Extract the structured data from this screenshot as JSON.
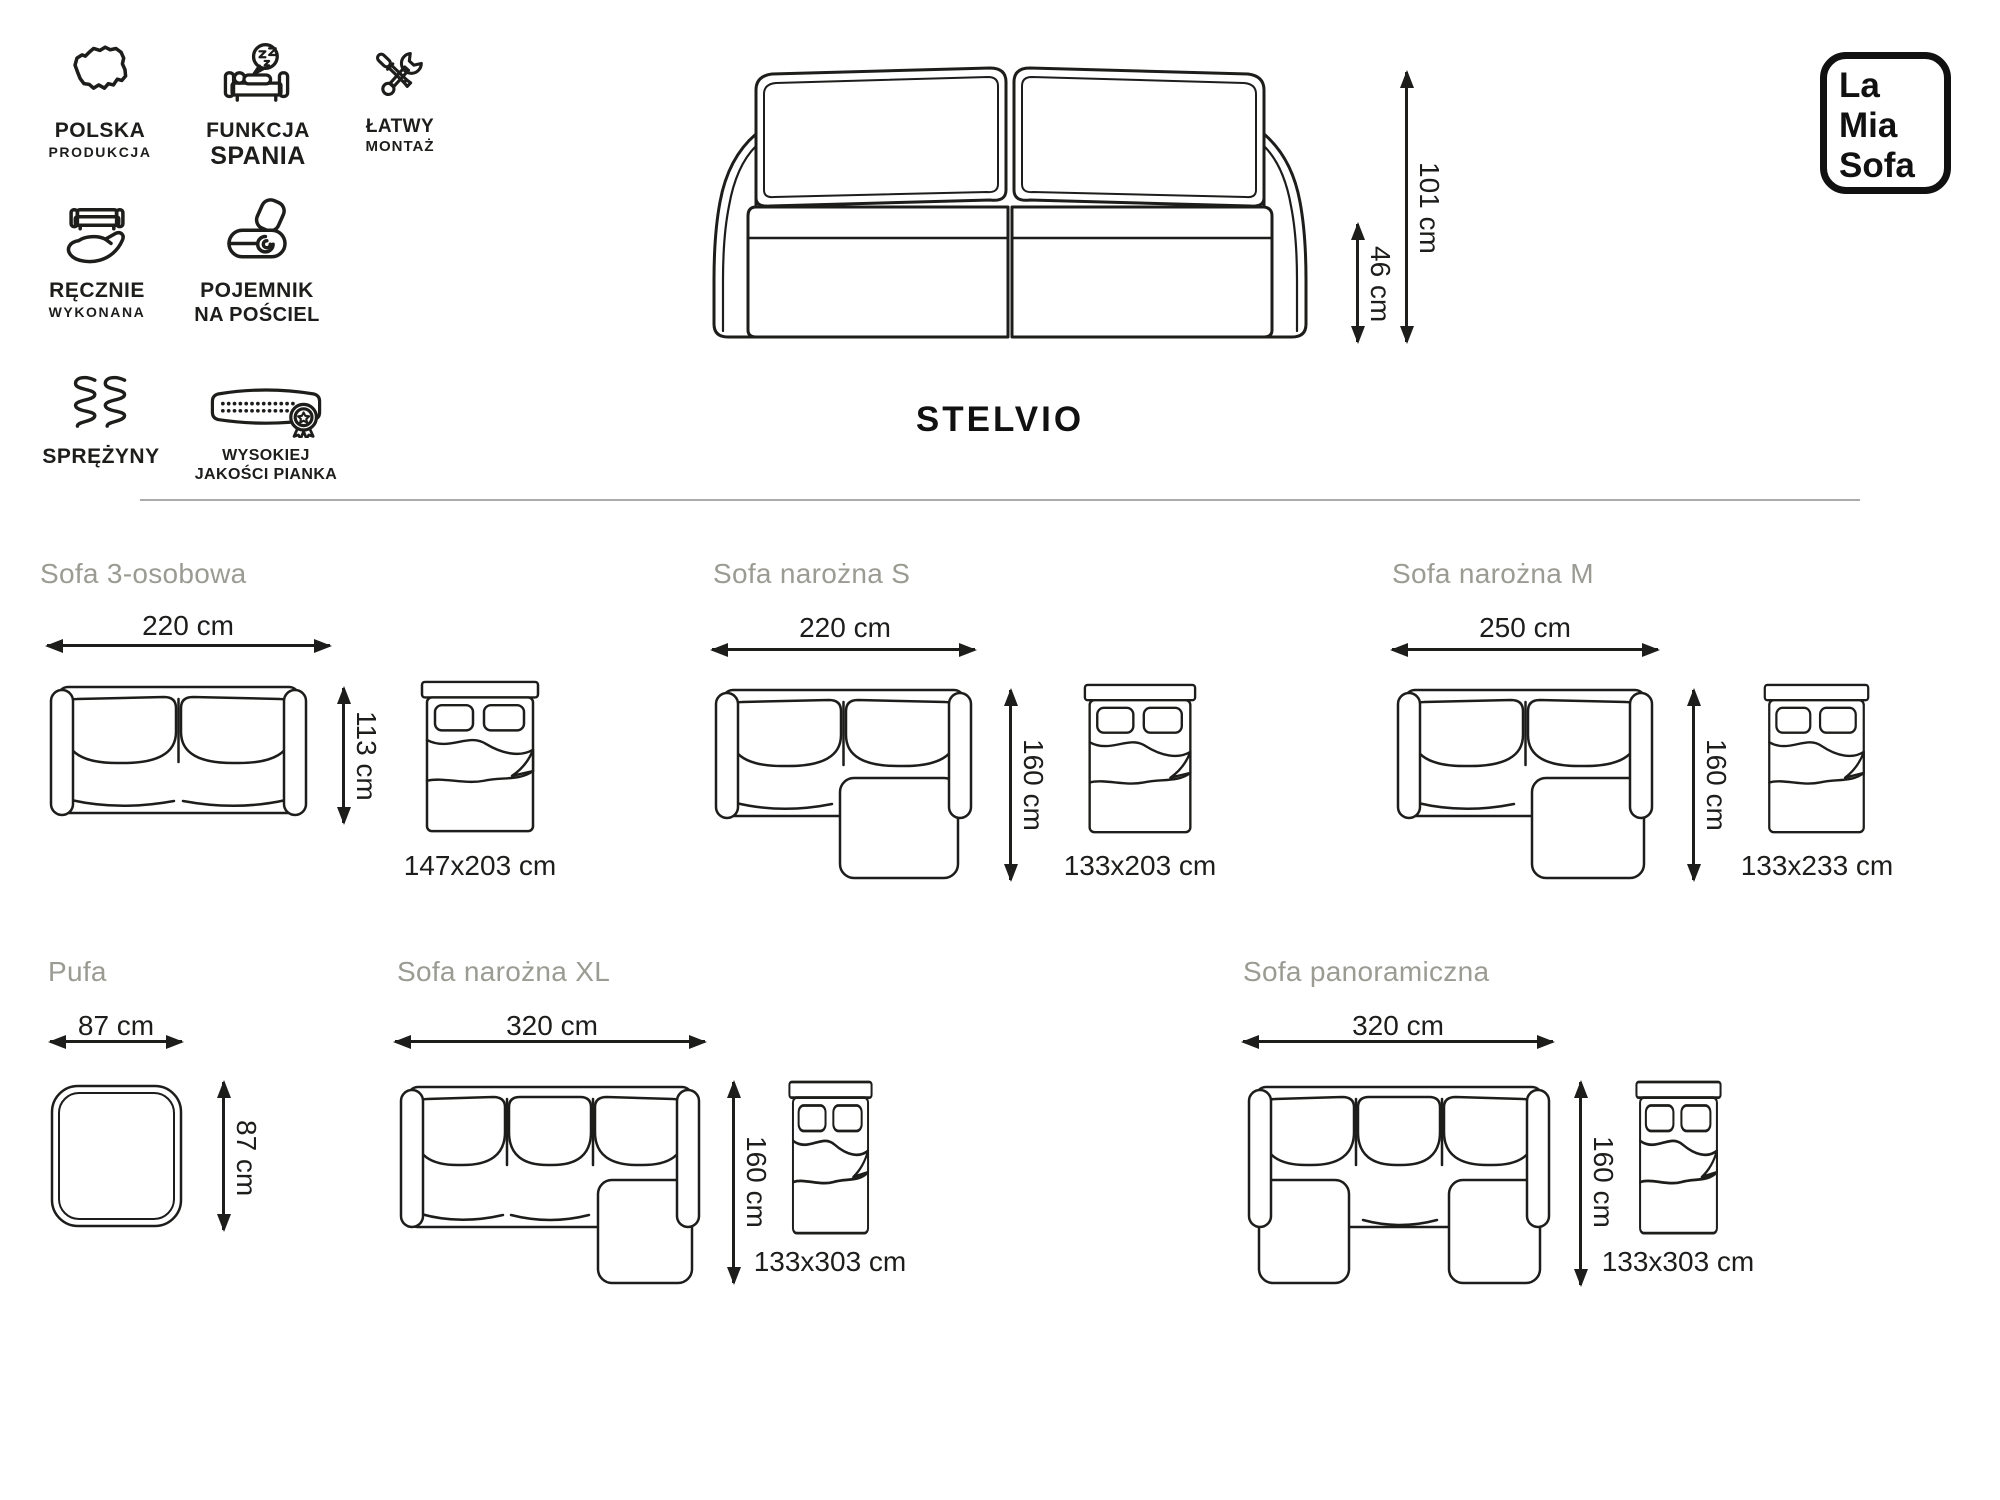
{
  "logo": {
    "lines": [
      "La",
      "Mia",
      "Sofa"
    ]
  },
  "product_name": "STELVIO",
  "front_view": {
    "height_label": "101 cm",
    "seat_height_label": "46 cm"
  },
  "features": [
    {
      "icon": "poland-map-icon",
      "line1": "POLSKA",
      "line2": "PRODUKCJA"
    },
    {
      "icon": "sleep-function-icon",
      "line1": "FUNKCJA",
      "line2": "SPANIA"
    },
    {
      "icon": "easy-assembly-icon",
      "line1": "ŁATWY",
      "line2": "MONTAŻ"
    },
    {
      "icon": "handmade-icon",
      "line1": "RĘCZNIE",
      "line2": "WYKONANA"
    },
    {
      "icon": "bedding-storage-icon",
      "line1": "POJEMNIK",
      "line2": "NA POŚCIEL"
    },
    {
      "icon": "springs-icon",
      "line1": "SPRĘŻYNY",
      "line2": ""
    },
    {
      "icon": "foam-quality-icon",
      "line1": "WYSOKIEJ",
      "line2": "JAKOŚCI PIANKA"
    }
  ],
  "variants": [
    {
      "name": "Sofa 3-osobowa",
      "width": "220 cm",
      "depth": "113 cm",
      "bed_size": "147x203 cm"
    },
    {
      "name": "Sofa narożna S",
      "width": "220 cm",
      "depth": "160 cm",
      "bed_size": "133x203 cm"
    },
    {
      "name": "Sofa narożna M",
      "width": "250 cm",
      "depth": "160 cm",
      "bed_size": "133x233 cm"
    },
    {
      "name": "Pufa",
      "width": "87 cm",
      "depth": "87 cm",
      "bed_size": ""
    },
    {
      "name": "Sofa narożna XL",
      "width": "320 cm",
      "depth": "160 cm",
      "bed_size": "133x303 cm"
    },
    {
      "name": "Sofa panoramiczna",
      "width": "320 cm",
      "depth": "160 cm",
      "bed_size": "133x303 cm"
    }
  ],
  "colors": {
    "ink": "#1d1d1b",
    "muted_title": "#9b9b93",
    "divider": "#ababab",
    "background": "#ffffff"
  }
}
